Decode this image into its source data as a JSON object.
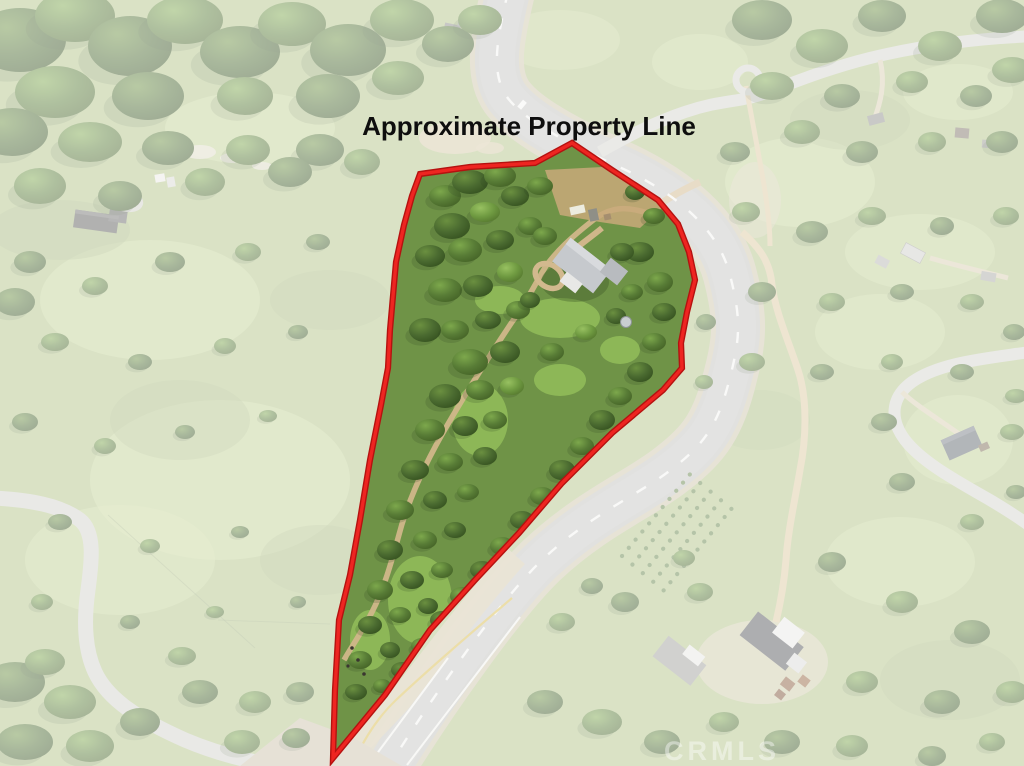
{
  "annotation": {
    "label": "Approximate Property Line",
    "label_color": "#0e0e0e",
    "line_color": "#ee2521",
    "line_outline_color": "#b51210",
    "polygon_points": "420,174 470,167 535,163 572,143 612,170 658,200 678,224 689,252 695,280 687,312 681,343 682,368 663,390 612,433 562,483 519,533 475,580 430,630 385,695 333,758 335,690 339,620 350,575 360,520 370,460 381,405 388,368 390,330 396,262 404,225 412,196"
  },
  "watermark": {
    "text": "CRMLS",
    "color": "#ffffff",
    "opacity": 0.42
  },
  "scene": {
    "wash_color": "#ffffff",
    "wash_opacity": 0.52,
    "meadow_color": "#b2c487",
    "forest_dark": "#46662f",
    "forest_mid": "#5d8038",
    "lawn_bright": "#90bb59",
    "road_asphalt": "#c1c1bd",
    "road_marking_white": "#f4f4f1",
    "road_marking_yellow": "#d9bb45",
    "dirt_color": "#d0b68a"
  }
}
